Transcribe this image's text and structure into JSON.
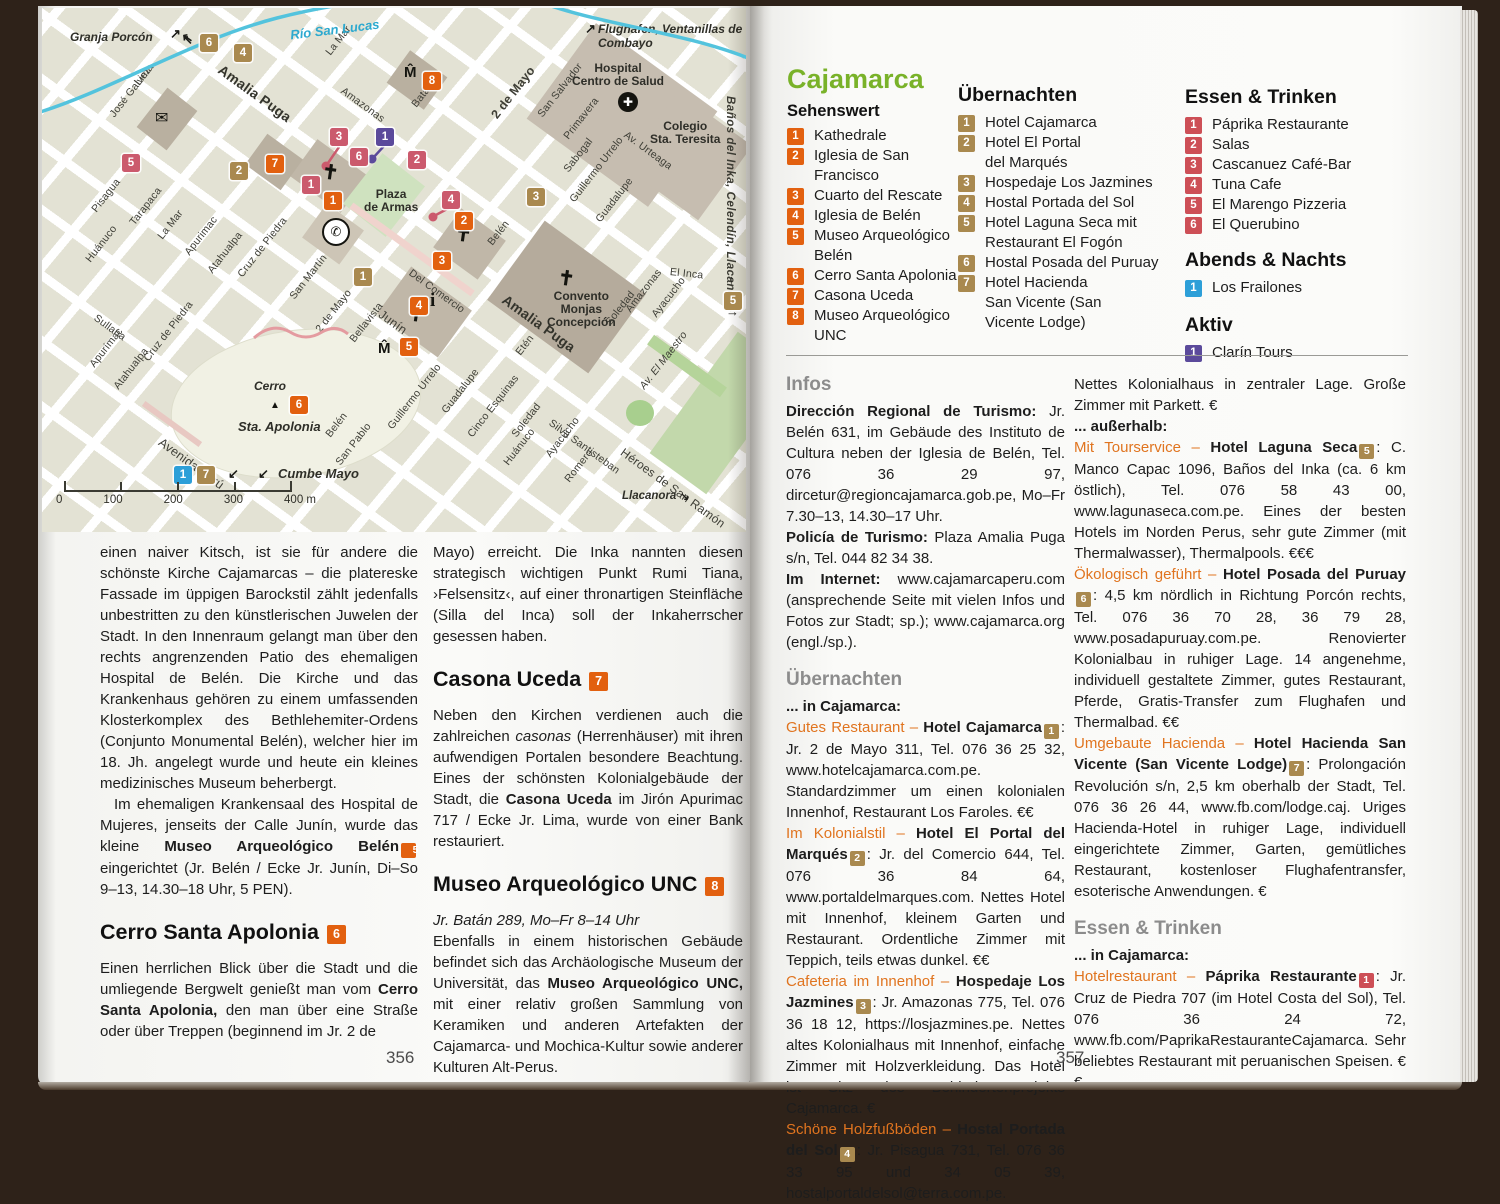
{
  "page": {
    "left_number": "356",
    "right_number": "357"
  },
  "map": {
    "river_label": "Río San Lucas",
    "edge": {
      "granja": "Granja Porcón",
      "flughafen1": "Flughafen, Ventanillas de Otuzco,",
      "flughafen2": "Combayo",
      "banos": "Baños del Inka, Celendín, Llacanora",
      "cumbe": "Cumbe Mayo",
      "llacanora": "Llacanora",
      "el_inca": "El Inca"
    },
    "places": {
      "hospital1": "Hospital",
      "hospital2": "Centro de Salud",
      "colegio1": "Colegio",
      "colegio2": "Sta. Teresita",
      "convento1": "Convento",
      "convento2": "Monjas",
      "convento3": "Concepción",
      "plaza1": "Plaza",
      "plaza2": "de Armas",
      "cerro1": "Cerro",
      "cerro2": "Sta. Apolonia"
    },
    "scale_ticks": [
      "0",
      "100",
      "200",
      "300",
      "400 m"
    ],
    "streets": [
      "Lima",
      "José Galvez",
      "Amalia Puga",
      "La Mar",
      "Amazonas",
      "Batán",
      "2 de Mayo",
      "San Salvador",
      "Primavera",
      "Sabogal",
      "Av. Urteaga",
      "Guillermo Urrelo",
      "Guadalupe",
      "Pisagua",
      "Tarapaca",
      "La Mar",
      "Apurimac",
      "Huánuco",
      "Junín",
      "Del Comercio",
      "San Martín",
      "2 de Mayo",
      "Bellavista",
      "Belén",
      "Sullana",
      "Apurímac",
      "Atahualpa",
      "Cruz de Piedra",
      "Atahualpa",
      "Cruz de Piedra",
      "Avenida Perú",
      "Belén",
      "San Pablo",
      "Guillermo Urrelo",
      "Guadalupe",
      "Cinco Esquinas",
      "Soledad",
      "Huánuco",
      "Ayacucho",
      "Silva Santisteban",
      "Romero",
      "Héroes de San Ramón",
      "Av. El Maestro",
      "Etén",
      "Amalia Puga",
      "Soledad",
      "Amazonas",
      "Ayacucho",
      "El Inca"
    ],
    "markers": {
      "sights": [
        "1",
        "2",
        "3",
        "4",
        "5",
        "6",
        "7",
        "8"
      ],
      "hotels": [
        "1",
        "2",
        "3",
        "4",
        "5",
        "6",
        "7"
      ],
      "foods": [
        "1",
        "2",
        "3",
        "4",
        "5",
        "6"
      ],
      "night": [
        "1"
      ],
      "active": [
        "1"
      ]
    },
    "icons": {
      "museum": "M̂",
      "envelope": "✉",
      "phone": "✆",
      "info": "i",
      "hospital": "✚",
      "church": "✝",
      "peak": "▲"
    }
  },
  "legend": {
    "title": "Cajamarca",
    "sehenswert": {
      "title": "Sehenswert",
      "items": [
        {
          "n": "1",
          "lines": [
            "Kathedrale"
          ]
        },
        {
          "n": "2",
          "lines": [
            "Iglesia de San Francisco"
          ]
        },
        {
          "n": "3",
          "lines": [
            "Cuarto del Rescate"
          ]
        },
        {
          "n": "4",
          "lines": [
            "Iglesia de Belén"
          ]
        },
        {
          "n": "5",
          "lines": [
            "Museo Arqueológico",
            "Belén"
          ]
        },
        {
          "n": "6",
          "lines": [
            "Cerro Santa Apolonia"
          ]
        },
        {
          "n": "7",
          "lines": [
            "Casona Uceda"
          ]
        },
        {
          "n": "8",
          "lines": [
            "Museo Arqueológico UNC"
          ]
        }
      ]
    },
    "uebernachten": {
      "title": "Übernachten",
      "items": [
        {
          "n": "1",
          "lines": [
            "Hotel Cajamarca"
          ]
        },
        {
          "n": "2",
          "lines": [
            "Hotel El Portal",
            "del Marqués"
          ]
        },
        {
          "n": "3",
          "lines": [
            "Hospedaje Los Jazmines"
          ]
        },
        {
          "n": "4",
          "lines": [
            "Hostal Portada del Sol"
          ]
        },
        {
          "n": "5",
          "lines": [
            "Hotel Laguna Seca mit",
            "Restaurant El Fogón"
          ]
        },
        {
          "n": "6",
          "lines": [
            "Hostal Posada del Puruay"
          ]
        },
        {
          "n": "7",
          "lines": [
            "Hotel Hacienda",
            "San Vicente (San",
            "Vicente Lodge)"
          ]
        }
      ]
    },
    "essen": {
      "title": "Essen & Trinken",
      "items": [
        {
          "n": "1",
          "lines": [
            "Páprika Restaurante"
          ]
        },
        {
          "n": "2",
          "lines": [
            "Salas"
          ]
        },
        {
          "n": "3",
          "lines": [
            "Cascanuez Café-Bar"
          ]
        },
        {
          "n": "4",
          "lines": [
            "Tuna Cafe"
          ]
        },
        {
          "n": "5",
          "lines": [
            "El Marengo Pizzeria"
          ]
        },
        {
          "n": "6",
          "lines": [
            "El Querubino"
          ]
        }
      ]
    },
    "abends": {
      "title": "Abends & Nachts",
      "items": [
        {
          "n": "1",
          "lines": [
            "Los Frailones"
          ]
        }
      ]
    },
    "aktiv": {
      "title": "Aktiv",
      "items": [
        {
          "n": "1",
          "lines": [
            "Clarín Tours"
          ]
        }
      ]
    }
  },
  "infos": {
    "heading": "Infos",
    "p1b": "Dirección Regional de Turismo: ",
    "p1": "Jr. Belén 631, im Gebäude des Instituto de Cultura neben der Iglesia de Belén, Tel. 076 36 29 97, dircetur@regioncajamarca.gob.pe, Mo–Fr 7.30–13, 14.30–17 Uhr.",
    "p2b": "Policía de Turismo: ",
    "p2": "Plaza Amalia Puga s/n, Tel. 044 82 34 38.",
    "p3b": "Im Internet: ",
    "p3": "www.cajamarcaperu.com (ansprechende Seite mit vielen Infos und Fotos zur Stadt; sp.); www.cajamarca.org (engl./sp.)."
  },
  "uebernachten_text": {
    "heading": "Übernachten",
    "sub": "... in Cajamarca:",
    "e1": {
      "lead": "Gutes Restaurant – ",
      "name": "Hotel Cajamarca",
      "n": "1",
      "text": ": Jr. 2 de Mayo 311, Tel. 076 36 25 32, www.hotelcajamarca.com.pe. Standardzimmer um einen kolonialen Innenhof, Restaurant Los Faroles. €€"
    },
    "e2": {
      "lead": "Im Kolonialstil – ",
      "name": "Hotel El Portal del Marqués",
      "n": "2",
      "text": ": Jr. del Comercio 644, Tel. 076 36 84 64, www.portaldelmarques.com. Nettes Hotel mit Innenhof, kleinem Garten und Restaurant. Ordentliche Zimmer mit Teppich, teils etwas dunkel. €€"
    },
    "e3": {
      "lead": "Cafeteria im Innenhof – ",
      "name": "Hospedaje Los Jazmines",
      "n": "3",
      "text": ": Jr. Amazonas 775, Tel. 076 36 18 12, https://losjazmines.pe. Nettes altes Kolonialhaus mit Innenhof, einfache Zimmer mit Holzverkleidung. Das Hotel ist Sitz des Behindertenprojekts Cajamarca. €"
    },
    "e4": {
      "lead": "Schöne Holzfußböden – ",
      "name": "Hostal Portada del Sol",
      "n": "4",
      "text": ": Jr. Pisagua 731, Tel. 076 36 33 95 und 34 05 39, hostalportaldelsol@terra.com.pe."
    },
    "e4cont": "Nettes Kolonialhaus in zentraler Lage. Große Zimmer mit Parkett. €",
    "sub2": "... außerhalb:",
    "e5": {
      "lead": "Mit Tourservice – ",
      "name": "Hotel Laguna Seca",
      "n": "5",
      "text": ": C. Manco Capac 1096, Baños del Inka (ca. 6 km östlich), Tel. 076 58 43 00, www.lagunaseca.com.pe. Eines der besten Hotels im Norden Perus, sehr gute Zimmer (mit Thermalwasser), Thermalpools. €€€"
    },
    "e6": {
      "lead": "Ökologisch geführt – ",
      "name": "Hotel Posada del Puruay",
      "n": "6",
      "text": ": 4,5 km nördlich in Richtung Porcón rechts, Tel. 076 36 70 28, 36 79 28, www.posadapuruay.com.pe. Renovierter Kolonialbau in ruhiger Lage. 14 angenehme, individuell gestaltete Zimmer, gutes Restaurant, Pferde, Gratis-Transfer zum Flughafen und Thermalbad. €€"
    },
    "e7": {
      "lead": "Umgebaute Hacienda – ",
      "name": "Hotel Hacienda San Vicente (San Vicente Lodge)",
      "n": "7",
      "text": ": Prolongación Revolución s/n, 2,5 km oberhalb der Stadt, Tel. 076 36 26 44, www.fb.com/lodge.caj. Uriges Hacienda-Hotel in ruhiger Lage, individuell eingerichtete Zimmer, Garten, gemütliches Restaurant, kostenloser Flughafentransfer, esoterische Anwendungen. €"
    }
  },
  "essen_text": {
    "heading": "Essen & Trinken",
    "sub": "... in Cajamarca:",
    "e1": {
      "lead": "Hotelrestaurant – ",
      "name": "Páprika Restaurante",
      "n": "1",
      "text": ": Jr. Cruz de Piedra 707 (im Hotel Costa del Sol), Tel. 076 36 24 72, www.fb.com/PaprikaRestauranteCajamarca. Sehr beliebtes Restaurant mit peruanischen Speisen. €€"
    }
  },
  "left_article": {
    "p1": "einen naiver Kitsch, ist sie für andere die schönste Kirche Cajamarcas – die platereske Fassade im üppigen Barockstil zählt jedenfalls unbestritten zu den künstlerischen Juwelen der Stadt. In den Innenraum gelangt man über den rechts angrenzenden Patio des ehemaligen Hospital de Belén. Die Kirche und das Krankenhaus gehören zu einem umfassenden Klosterkomplex des Bethlehemiter-Ordens (Conjunto Monumental Belén), welcher hier im 18. Jh. angelegt wurde und heute ein kleines medizinisches Museum beherbergt.",
    "p2a": "Im ehemaligen Krankensaal des Hospital de Mujeres, jenseits der Calle Junín, wurde das kleine ",
    "p2b": "Museo Arqueológico Belén",
    "p2n": "5",
    "p2c": " eingerichtet (Jr. Belén / Ecke Jr. Junín, Di–So 9–13, 14.30–18 Uhr, 5 PEN).",
    "h1": "Cerro Santa Apolonia",
    "h1n": "6",
    "p3a": "Einen herrlichen Blick über die Stadt und die umliegende Bergwelt genießt man vom ",
    "p3b": "Cerro Santa Apolonia,",
    "p3c": " den man über eine Straße oder über Treppen (beginnend im Jr. 2 de",
    "p4": "Mayo) erreicht. Die Inka nannten diesen strategisch wichtigen Punkt Rumi Tiana, ›Felsensitz‹, auf einer thronartigen Steinfläche (Silla del Inca) soll der Inkaherrscher gesessen haben.",
    "h2": "Casona Uceda",
    "h2n": "7",
    "p5a": "Neben den Kirchen verdienen auch die zahlreichen ",
    "p5i": "casonas",
    "p5b": " (Herrenhäuser) mit ihren aufwendigen Portalen besondere Beachtung. Eines der schönsten Kolonialgebäude der Stadt, die ",
    "p5c": "Casona Uceda",
    "p5d": " im Jirón Apurimac 717 / Ecke Jr. Lima, wurde von einer Bank restauriert.",
    "h3": "Museo Arqueológico UNC",
    "h3n": "8",
    "p6i": "Jr. Batán 289, Mo–Fr 8–14 Uhr",
    "p7a": "Ebenfalls in einem historischen Gebäude befindet sich das Archäologische Museum der Universität, das ",
    "p7b": "Museo Arqueológico UNC,",
    "p7c": " mit einer relativ großen Sammlung von Keramiken und anderen Artefakten der Cajamarca- und Mochica-Kultur sowie anderer Kulturen Alt-Perus."
  }
}
